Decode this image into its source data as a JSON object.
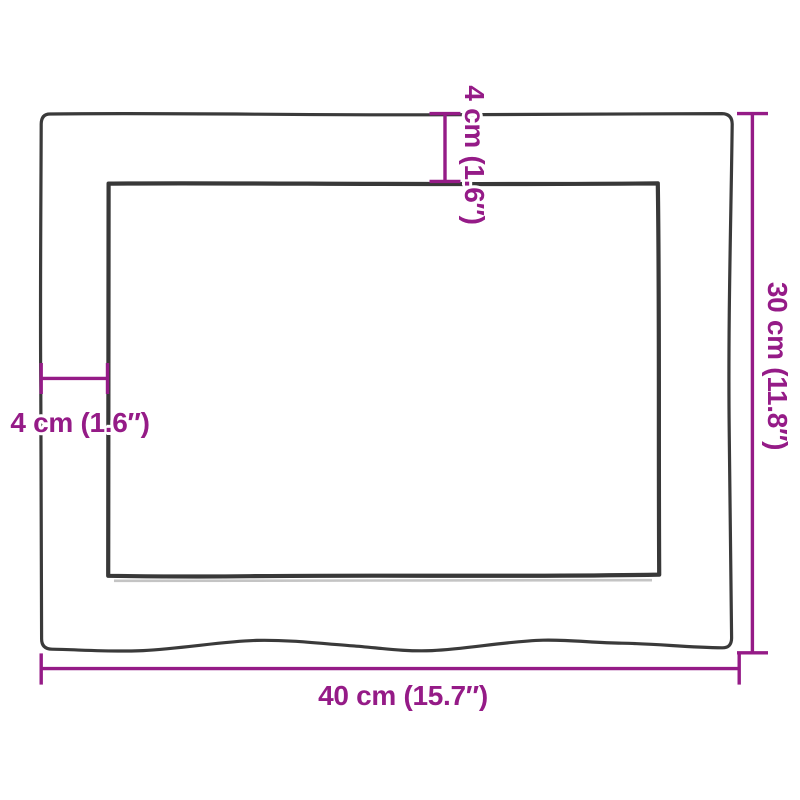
{
  "diagram": {
    "kind": "product-dimension-diagram",
    "shape": "rectangular board with recessed inner panel and wavy live bottom edge",
    "colors": {
      "dimension_accent": "#951b87",
      "outline": "#3a3a3a",
      "background": "#ffffff"
    },
    "dimensions": {
      "width": {
        "label": "40 cm (15.7″)",
        "value_cm": 40,
        "value_in": 15.7,
        "position": "bottom"
      },
      "height": {
        "label": "30 cm (11.8″)",
        "value_cm": 30,
        "value_in": 11.8,
        "position": "right"
      },
      "border_top": {
        "label": "4 cm (1.6″)",
        "value_cm": 4,
        "value_in": 1.6,
        "position": "top"
      },
      "border_left": {
        "label": "4 cm (1.6″)",
        "value_cm": 4,
        "value_in": 1.6,
        "position": "left"
      }
    }
  }
}
